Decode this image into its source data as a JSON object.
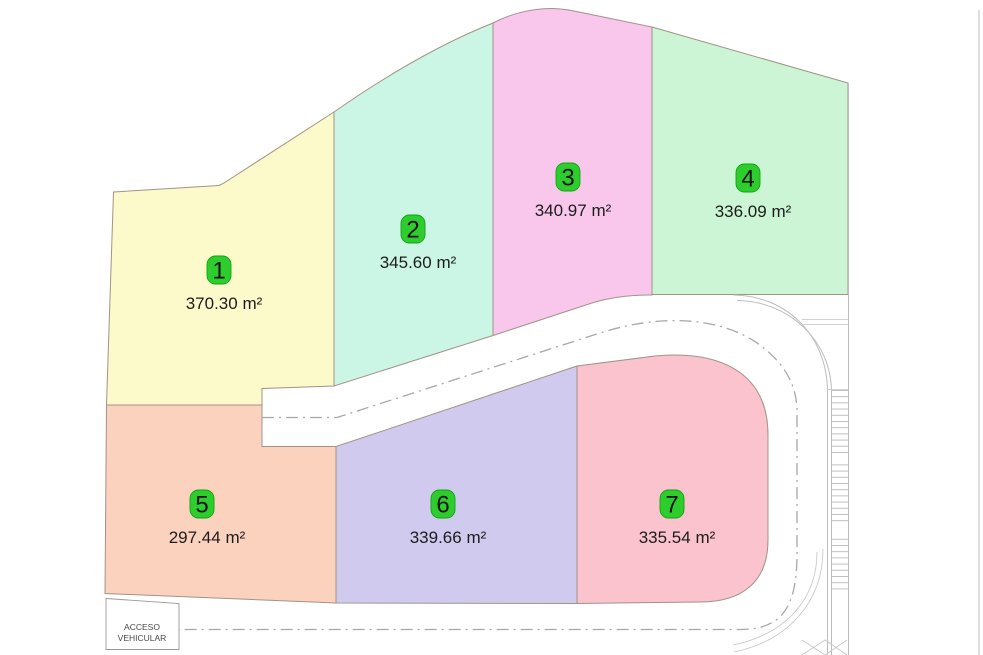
{
  "plan": {
    "kind": "lot-subdivision-site-plan",
    "lots": [
      {
        "number": "1",
        "area": "370.30 m²",
        "color": "#FCFACB"
      },
      {
        "number": "2",
        "area": "345.60 m²",
        "color": "#CBF5E5"
      },
      {
        "number": "3",
        "area": "340.97 m²",
        "color": "#FAC7EC"
      },
      {
        "number": "4",
        "area": "336.09 m²",
        "color": "#CBF5D5"
      },
      {
        "number": "5",
        "area": "297.44 m²",
        "color": "#FAD2BD"
      },
      {
        "number": "6",
        "area": "339.66 m²",
        "color": "#D1CAEF"
      },
      {
        "number": "7",
        "area": "335.54 m²",
        "color": "#FAC3CD"
      }
    ],
    "badge": {
      "fill": "#2ECD2E",
      "stroke": "#12A312",
      "text_color": "#111111"
    },
    "access_label": {
      "line1": "ACCESO",
      "line2": "VEHICULAR"
    },
    "colors": {
      "parcel_border": "#a39386",
      "road_line": "#bdbdbd",
      "centerline": "#a8a8a8",
      "label_text": "#1c1c1c",
      "background": "#ffffff"
    }
  }
}
